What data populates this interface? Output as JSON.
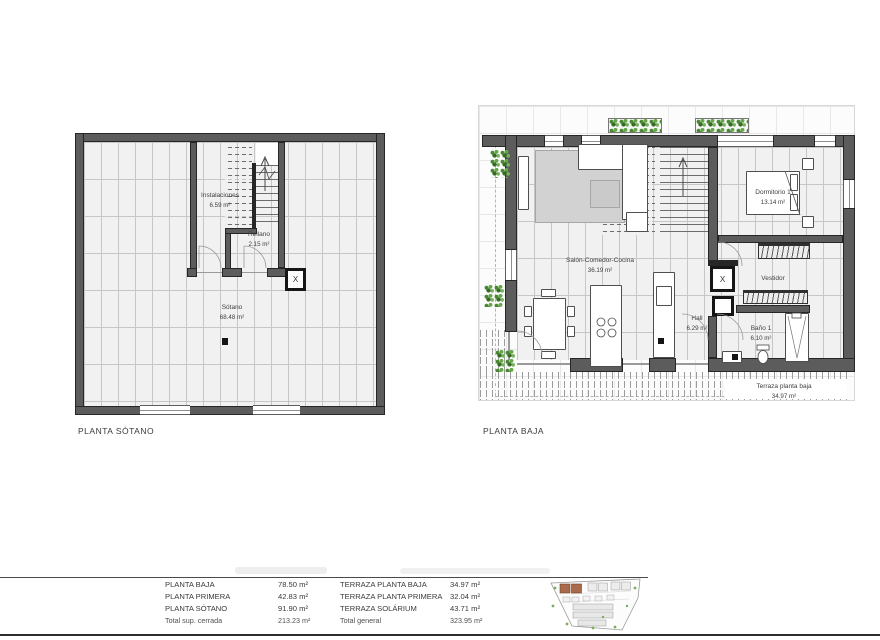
{
  "colors": {
    "wall": "#5c5c5c",
    "wall_dark": "#262626",
    "floor": "#f1f1f1",
    "grid_line": "#c6c6c6",
    "rug": "#d2d2d2",
    "plant_green": "#4d8c36",
    "site_highlight": "#a96b4c",
    "text": "#3e3e3e"
  },
  "plans": {
    "sotano": {
      "title": "PLANTA SÓTANO",
      "elevator_mark": "X",
      "rooms": {
        "instalaciones": {
          "name": "Instalaciones",
          "area": "6.59 m²"
        },
        "rellano": {
          "name": "Rellano",
          "area": "2.15 m²"
        },
        "sotano": {
          "name": "Sótano",
          "area": "68.48 m²"
        }
      }
    },
    "baja": {
      "title": "PLANTA BAJA",
      "elevator_mark": "X",
      "rooms": {
        "salon": {
          "name": "Salón-Comedor-Cocina",
          "area": "36.19 m²"
        },
        "hall": {
          "name": "Hall",
          "area": "6.29 m²"
        },
        "dormitorio": {
          "name": "Dormitorio 1",
          "area": "13.14 m²"
        },
        "vestidor": {
          "name": "Vestidor"
        },
        "bano": {
          "name": "Baño 1",
          "area": "6.10 m²"
        },
        "terraza": {
          "name": "Terraza planta baja",
          "area": "34.97 m²"
        }
      }
    }
  },
  "summary": {
    "left": [
      {
        "label": "PLANTA BAJA",
        "value": "78.50 m²"
      },
      {
        "label": "PLANTA PRIMERA",
        "value": "42.83 m²"
      },
      {
        "label": "PLANTA SÓTANO",
        "value": "91.90 m²"
      },
      {
        "label": "Total sup. cerrada",
        "value": "213.23 m²"
      }
    ],
    "right": [
      {
        "label": "TERRAZA PLANTA BAJA",
        "value": "34.97 m²"
      },
      {
        "label": "TERRAZA PLANTA PRIMERA",
        "value": "32.04 m²"
      },
      {
        "label": "TERRAZA SOLÁRIUM",
        "value": "43.71 m²"
      },
      {
        "label": "Total general",
        "value": "323.95 m²"
      }
    ]
  }
}
